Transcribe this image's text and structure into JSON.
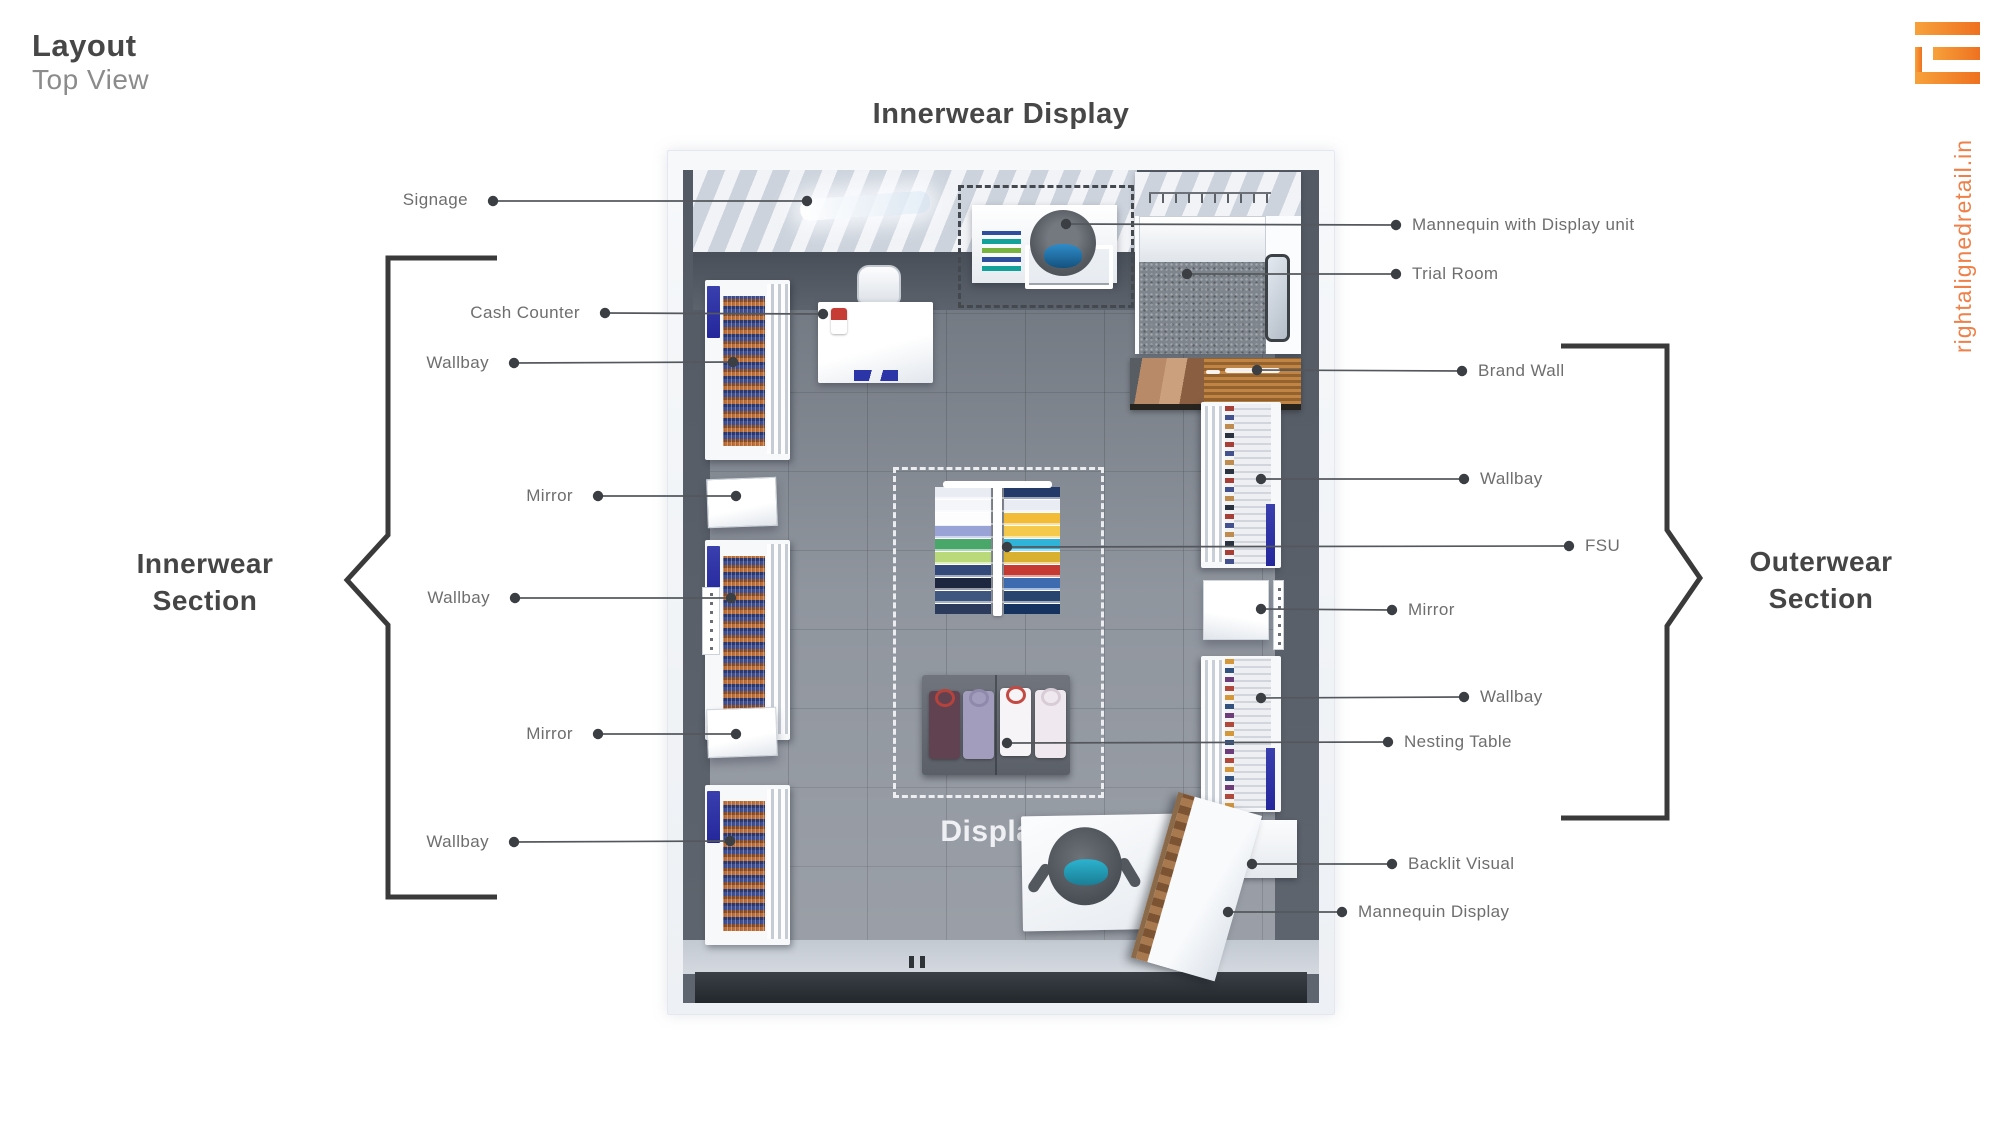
{
  "header": {
    "title": "Layout",
    "subtitle": "Top View"
  },
  "branding": {
    "website": "rightalignedretail.in",
    "logo_color": "#f47b20"
  },
  "plan": {
    "title": "Innerwear Display",
    "display_zone_label": "Display"
  },
  "sections": {
    "left": {
      "line1": "Innerwear",
      "line2": "Section"
    },
    "right": {
      "line1": "Outerwear",
      "line2": "Section"
    }
  },
  "labels": {
    "left": [
      "Signage",
      "Cash Counter",
      "Wallbay",
      "Mirror",
      "Wallbay",
      "Mirror",
      "Wallbay"
    ],
    "right": [
      "Mannequin with Display unit",
      "Trial Room",
      "Brand Wall",
      "Wallbay",
      "FSU",
      "Mirror",
      "Wallbay",
      "Nesting Table",
      "Backlit Visual",
      "Mannequin Display"
    ]
  },
  "colors": {
    "accent_orange": "#f47b20",
    "label_text": "#6e6e6e",
    "heading_text": "#474747",
    "leader_line": "#54585d",
    "bracket": "#3a3a3a",
    "blue_sign": "#2c31a6",
    "floor_gray": "#8a9099",
    "wall_dark": "#5d636c"
  }
}
